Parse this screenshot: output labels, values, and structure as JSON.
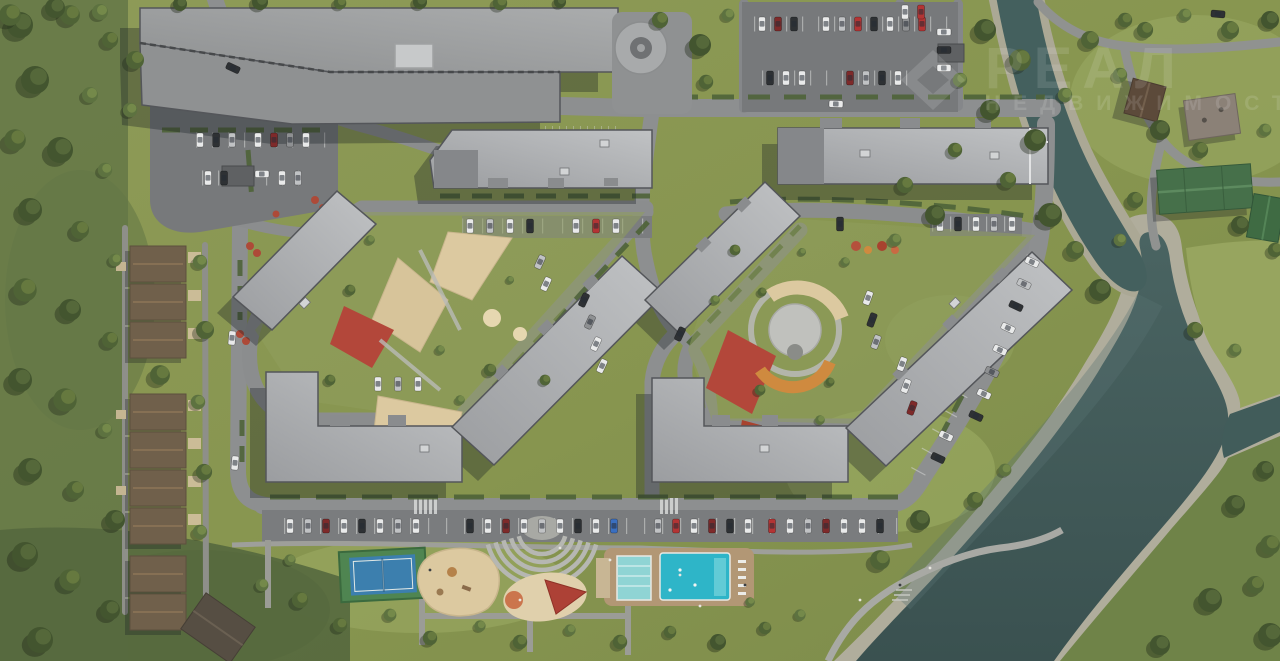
{
  "meta": {
    "title": "Аэровид генплана жилого комплекса у реки — 3D-рендер сверху",
    "view": "top-down aerial render"
  },
  "watermark": {
    "logo": "diamond-logo",
    "brand": "РЕАЛ",
    "tagline": "НЕДВИЖИМОСТЬ"
  },
  "palette": {
    "grass": "#87954f",
    "forest": "#44552f",
    "asphalt": "#8d8f90",
    "parking_lot": "#77797b",
    "roof": "#aeb0b2",
    "water": "#45605e",
    "pebble": "#aeab9a",
    "sand": "#dcc9a0",
    "rubber_red": "#b3473a",
    "pool": "#2eb5c8",
    "lap_pool": "#8fd4d4",
    "tennis_blue": "#3c7fae",
    "tennis_green": "#4f8551",
    "townhouse_roof": "#70604b",
    "green_roof": "#46704a"
  },
  "scene": {
    "features": [
      "parking garage with circular ramp",
      "two residential courtyard blocks",
      "children playgrounds with sand and red rubber surfacing",
      "street and courtyard parking with cars",
      "townhouse row on the west side",
      "amenity strip: tennis court, playground, amphitheater, two swimming pools",
      "riverside promenade",
      "river with pebble banks and tributary",
      "suburban houses across the stream"
    ]
  }
}
